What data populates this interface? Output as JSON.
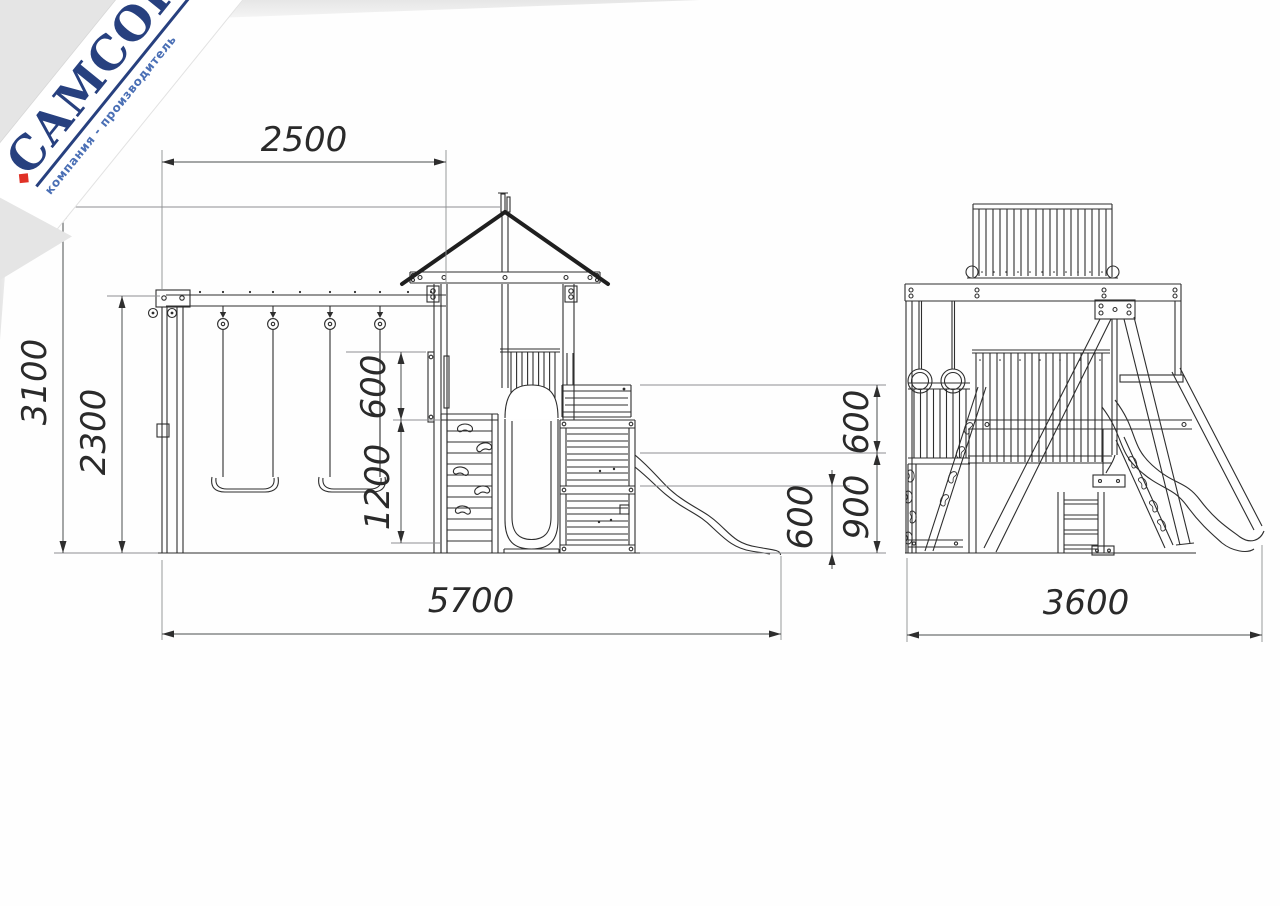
{
  "logo": {
    "title": "САМСОН",
    "subtitle": "компания - производитель"
  },
  "colors": {
    "brand_navy": "#27407f",
    "subtitle_blue": "#4a6fb5",
    "accent_red": "#e03126",
    "structure_line": "#2e2e2e",
    "dimension_line": "#4b4d4f",
    "extension_line": "#8d8f91",
    "corner_gray": "#e5e5e5"
  },
  "front_view": {
    "dimensions": {
      "width_top": "2500",
      "height_total": "3100",
      "height_swing_beam": "2300",
      "tower_upper": "600",
      "tower_lower": "1200",
      "length_total": "5700",
      "guard_rail_height": "600",
      "platform_height": "900",
      "slide_exit_height": "600"
    }
  },
  "side_view": {
    "dimensions": {
      "depth_total": "3600"
    }
  }
}
